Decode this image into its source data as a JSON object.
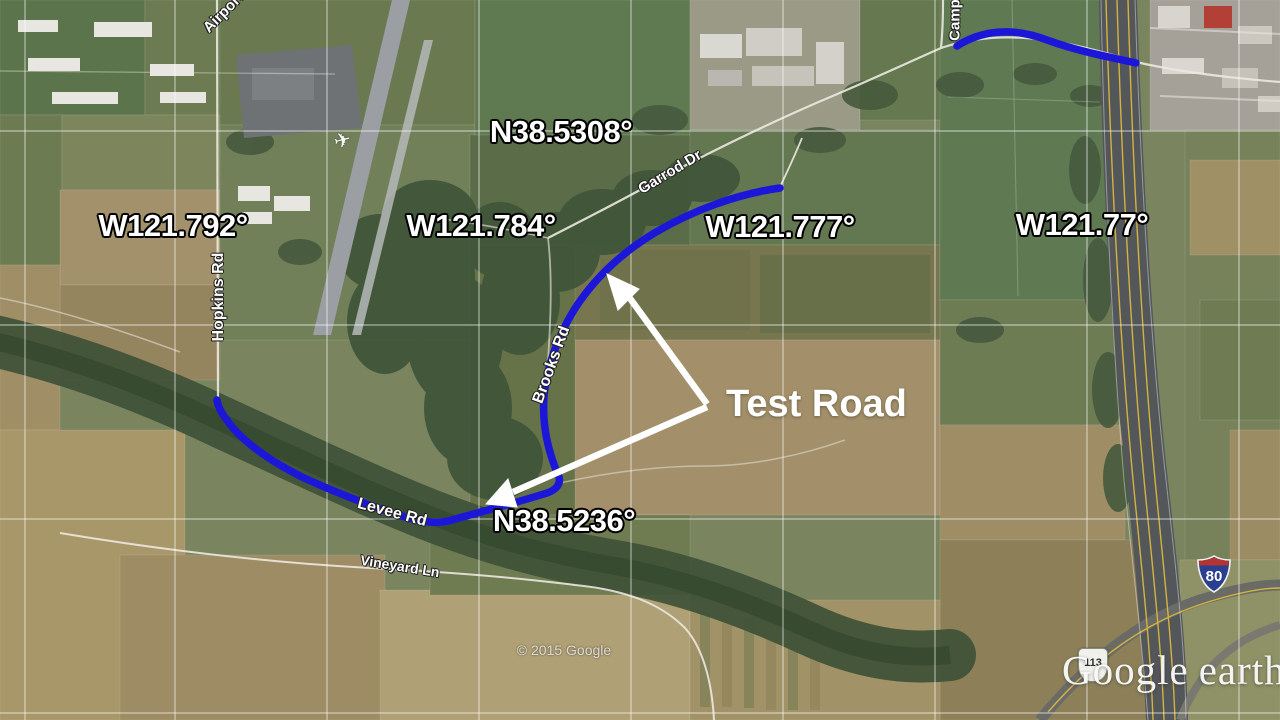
{
  "attribution": "© 2015 Google",
  "watermark": {
    "google": "Google",
    "earth": "earth"
  },
  "annotation": {
    "test_road": "Test Road"
  },
  "graticule": {
    "labels": [
      {
        "text": "N38.5308°"
      },
      {
        "text": "W121.792°"
      },
      {
        "text": "W121.784°"
      },
      {
        "text": "W121.777°"
      },
      {
        "text": "W121.77°"
      },
      {
        "text": "N38.5236°"
      }
    ]
  },
  "roads": {
    "airport": "Airport Rd",
    "camp": "Camp",
    "hopkins": "Hopkins Rd",
    "garrod": "Garrod Dr",
    "brooks": "Brooks Rd",
    "levee": "Levee Rd",
    "vineyard": "Vineyard Ln"
  },
  "shields": {
    "interstate": "80",
    "state": "113"
  },
  "icons": {
    "airplane": "✈"
  },
  "colors": {
    "highlight_blue": "#1c17d8",
    "annotation_white": "#ffffff",
    "graticule_line": "rgba(255,255,255,0.55)",
    "freeway_yellow": "#d9b83f"
  }
}
